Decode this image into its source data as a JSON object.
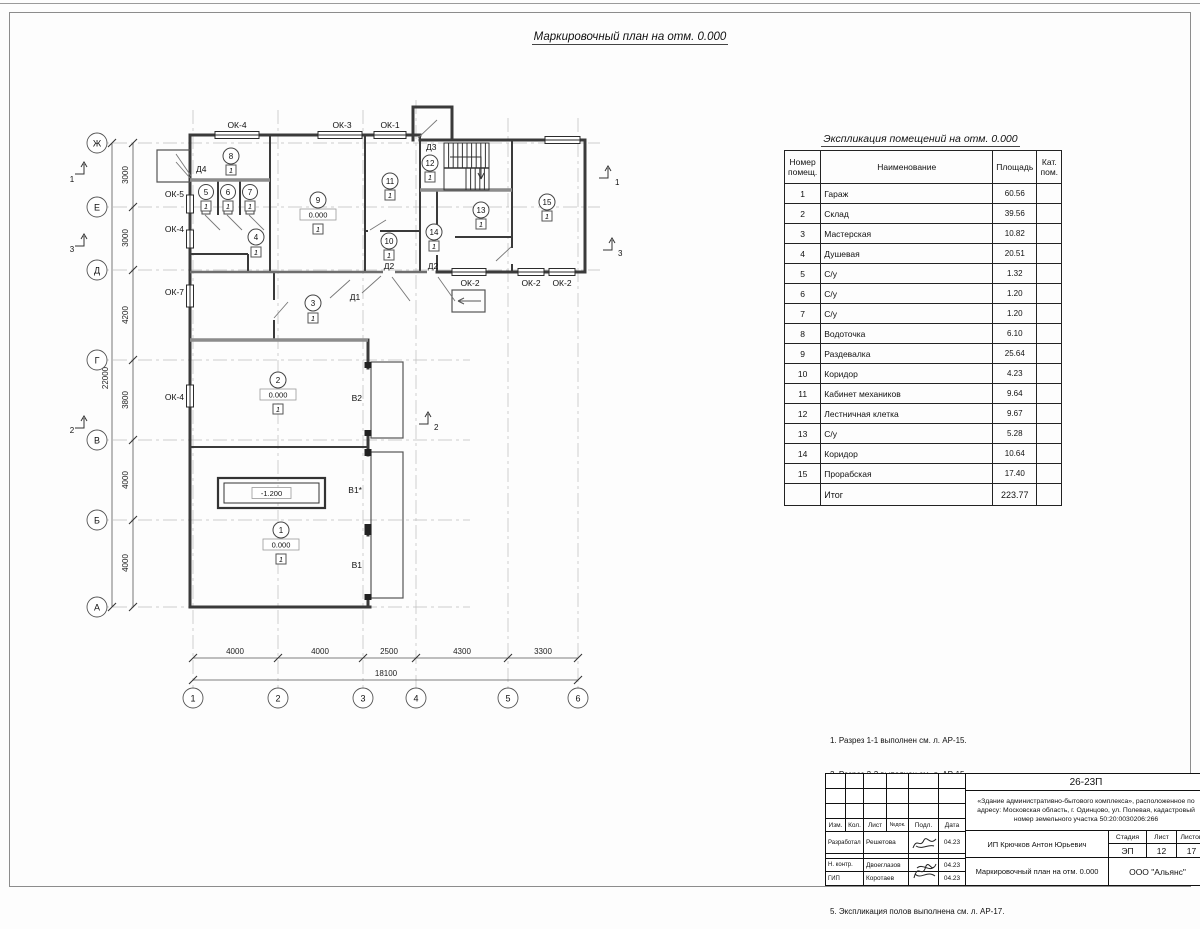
{
  "sheet": {
    "title": "Маркировочный план на отм. 0.000"
  },
  "plan": {
    "row_axes": [
      "Ж",
      "Е",
      "Д",
      "Г",
      "В",
      "Б",
      "А"
    ],
    "col_axes": [
      "1",
      "2",
      "3",
      "4",
      "5",
      "6"
    ],
    "left_dims": [
      "3000",
      "3000",
      "4200",
      "3800",
      "4000",
      "4000"
    ],
    "left_total": "22000",
    "bottom_dims": [
      "4000",
      "4000",
      "2500",
      "4300",
      "3300"
    ],
    "bottom_total": "18100",
    "floor_mark": "1",
    "pit_elev": "-1.200",
    "rooms": [
      {
        "num": "1",
        "elev": "0.000"
      },
      {
        "num": "2",
        "elev": "0.000"
      },
      {
        "num": "3"
      },
      {
        "num": "4"
      },
      {
        "num": "5"
      },
      {
        "num": "6"
      },
      {
        "num": "7"
      },
      {
        "num": "8"
      },
      {
        "num": "9",
        "elev": "0.000"
      },
      {
        "num": "10"
      },
      {
        "num": "11"
      },
      {
        "num": "12"
      },
      {
        "num": "13"
      },
      {
        "num": "14"
      },
      {
        "num": "15"
      }
    ],
    "window_labels": [
      "ОК-4",
      "ОК-3",
      "ОК-1",
      "ОК-5",
      "ОК-4",
      "ОК-7",
      "ОК-4",
      "ОК-2",
      "ОК-2",
      "ОК-2"
    ],
    "door_labels": [
      "Д4",
      "Д3",
      "Д2",
      "Д2",
      "Д1"
    ],
    "gate_labels": [
      "В2",
      "В1*",
      "В1"
    ],
    "section_labels": [
      "1",
      "3",
      "2",
      "1",
      "3",
      "2"
    ]
  },
  "table": {
    "title": "Экспликация помещений на отм. 0.000",
    "headers": [
      "Номер\nпомещ.",
      "Наименование",
      "Площадь",
      "Кат.\nпом."
    ],
    "rows": [
      {
        "num": "1",
        "name": "Гараж",
        "area": "60.56"
      },
      {
        "num": "2",
        "name": "Склад",
        "area": "39.56"
      },
      {
        "num": "3",
        "name": "Мастерская",
        "area": "10.82"
      },
      {
        "num": "4",
        "name": "Душевая",
        "area": "20.51"
      },
      {
        "num": "5",
        "name": "С/у",
        "area": "1.32"
      },
      {
        "num": "6",
        "name": "С/у",
        "area": "1.20"
      },
      {
        "num": "7",
        "name": "С/у",
        "area": "1.20"
      },
      {
        "num": "8",
        "name": "Водоточка",
        "area": "6.10"
      },
      {
        "num": "9",
        "name": "Раздевалка",
        "area": "25.64"
      },
      {
        "num": "10",
        "name": "Коридор",
        "area": "4.23"
      },
      {
        "num": "11",
        "name": "Кабинет механиков",
        "area": "9.64"
      },
      {
        "num": "12",
        "name": "Лестничная клетка",
        "area": "9.67"
      },
      {
        "num": "13",
        "name": "С/у",
        "area": "5.28"
      },
      {
        "num": "14",
        "name": "Коридор",
        "area": "10.64"
      },
      {
        "num": "15",
        "name": "Прорабская",
        "area": "17.40"
      }
    ],
    "total_label": "Итог",
    "total_area": "223.77"
  },
  "notes": {
    "lines": [
      "1. Разрез 1-1 выполнен см. л. АР-15.",
      "2. Разрез 2-2 выполнен см. л. АР-15.",
      "3. Разрез 3-3 выполнен см. л. АР-16.",
      "4. Спецификация заполнения оконных и дверных",
      "проемов выполнена см. л. АР-17.",
      "5. Экспликация полов выполнена см. л. АР-17."
    ]
  },
  "stamp": {
    "code": "26-23П",
    "object": "«Здание административно-бытового комплекса», расположенное по адресу: Московская область, г. Одинцово, ул. Полевая, кадастровый номер земельного участка 50:20:0030206:266",
    "header_cols": [
      "Изм.",
      "Кол.",
      "Лист",
      "№док.",
      "Подл.",
      "Дата"
    ],
    "rows": [
      {
        "role": "Разработал",
        "name": "Решетова",
        "date": "04.23"
      },
      {
        "role": "Н. контр.",
        "name": "Двоеглазов",
        "date": "04.23"
      },
      {
        "role": "ГИП",
        "name": "Коротаев",
        "date": "04.23"
      }
    ],
    "client": "ИП Крючков Антон Юрьевич",
    "stage_label": "Стадия",
    "sheet_label": "Лист",
    "sheets_label": "Листов",
    "stage": "ЭП",
    "sheet_num": "12",
    "sheets_num": "17",
    "doc_title": "Маркировочный план на отм. 0.000",
    "company": "ООО \"Альянс\""
  }
}
